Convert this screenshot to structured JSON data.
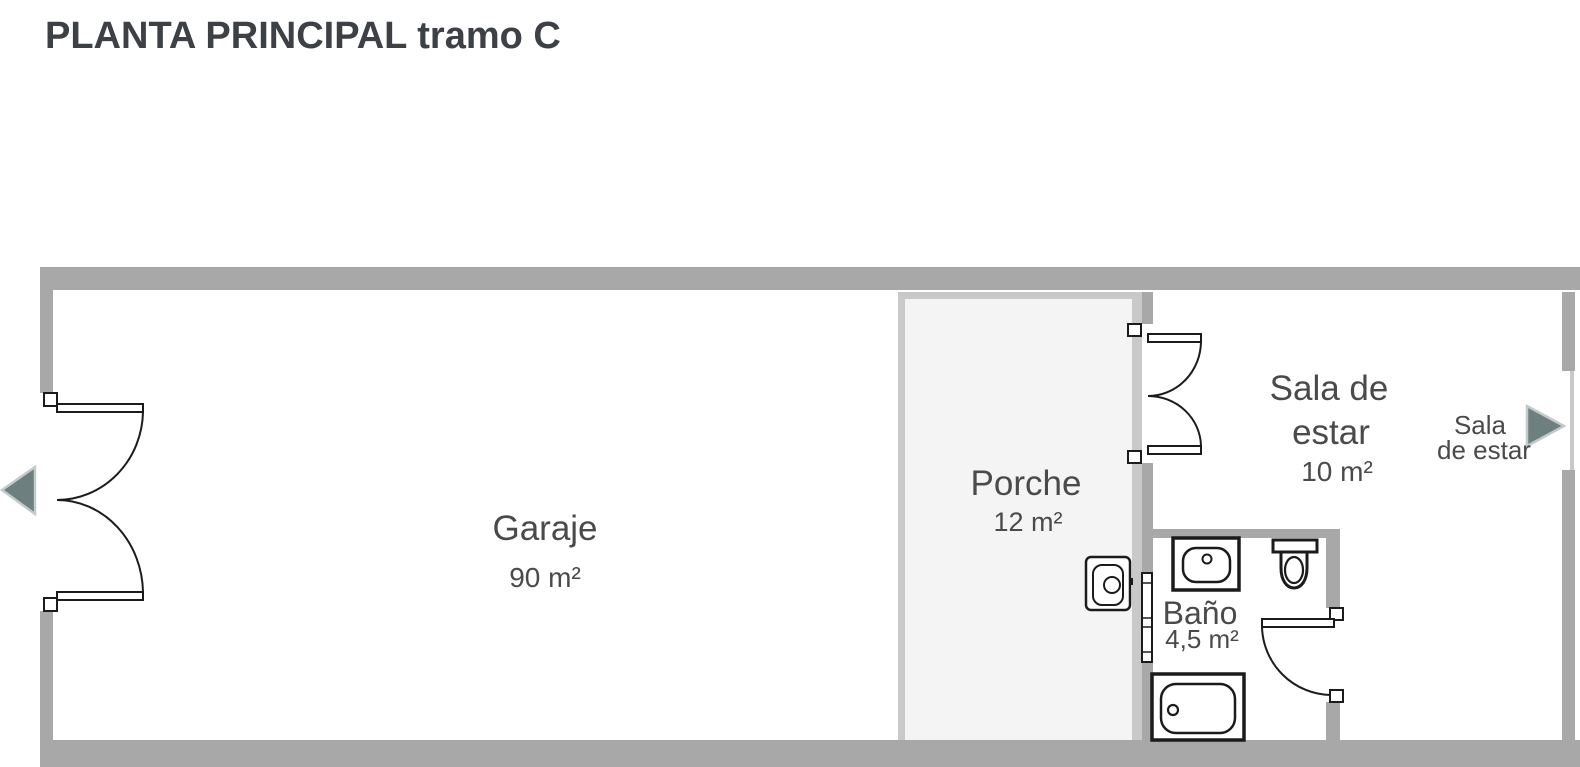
{
  "title": "PLANTA PRINCIPAL tramo C",
  "colors": {
    "wall": "#a8a8a8",
    "porch_border": "#c9c9c9",
    "porch_floor": "#f4f4f4",
    "line": "#1b1b1b",
    "arrow_fill": "#6e7f80",
    "arrow_stroke": "#c2caca",
    "label": "#4a4a4a",
    "title_color": "#3d4045"
  },
  "rooms": [
    {
      "name": "Garaje",
      "area": "90 m²"
    },
    {
      "name": "Porche",
      "area": "12 m²"
    },
    {
      "name": "Sala de estar",
      "name_lines": [
        "Sala de",
        "estar"
      ],
      "area": "10 m²"
    },
    {
      "name": "Baño",
      "area": "4,5 m²"
    }
  ],
  "nav": {
    "right_arrow": {
      "label_lines": [
        "Sala",
        "de estar"
      ]
    },
    "left_arrow": {
      "label_lines": []
    }
  },
  "fixtures": [
    "double-entry-door",
    "double-interior-door",
    "bathroom-door",
    "window",
    "water-heater",
    "sink",
    "toilet",
    "bathtub"
  ]
}
